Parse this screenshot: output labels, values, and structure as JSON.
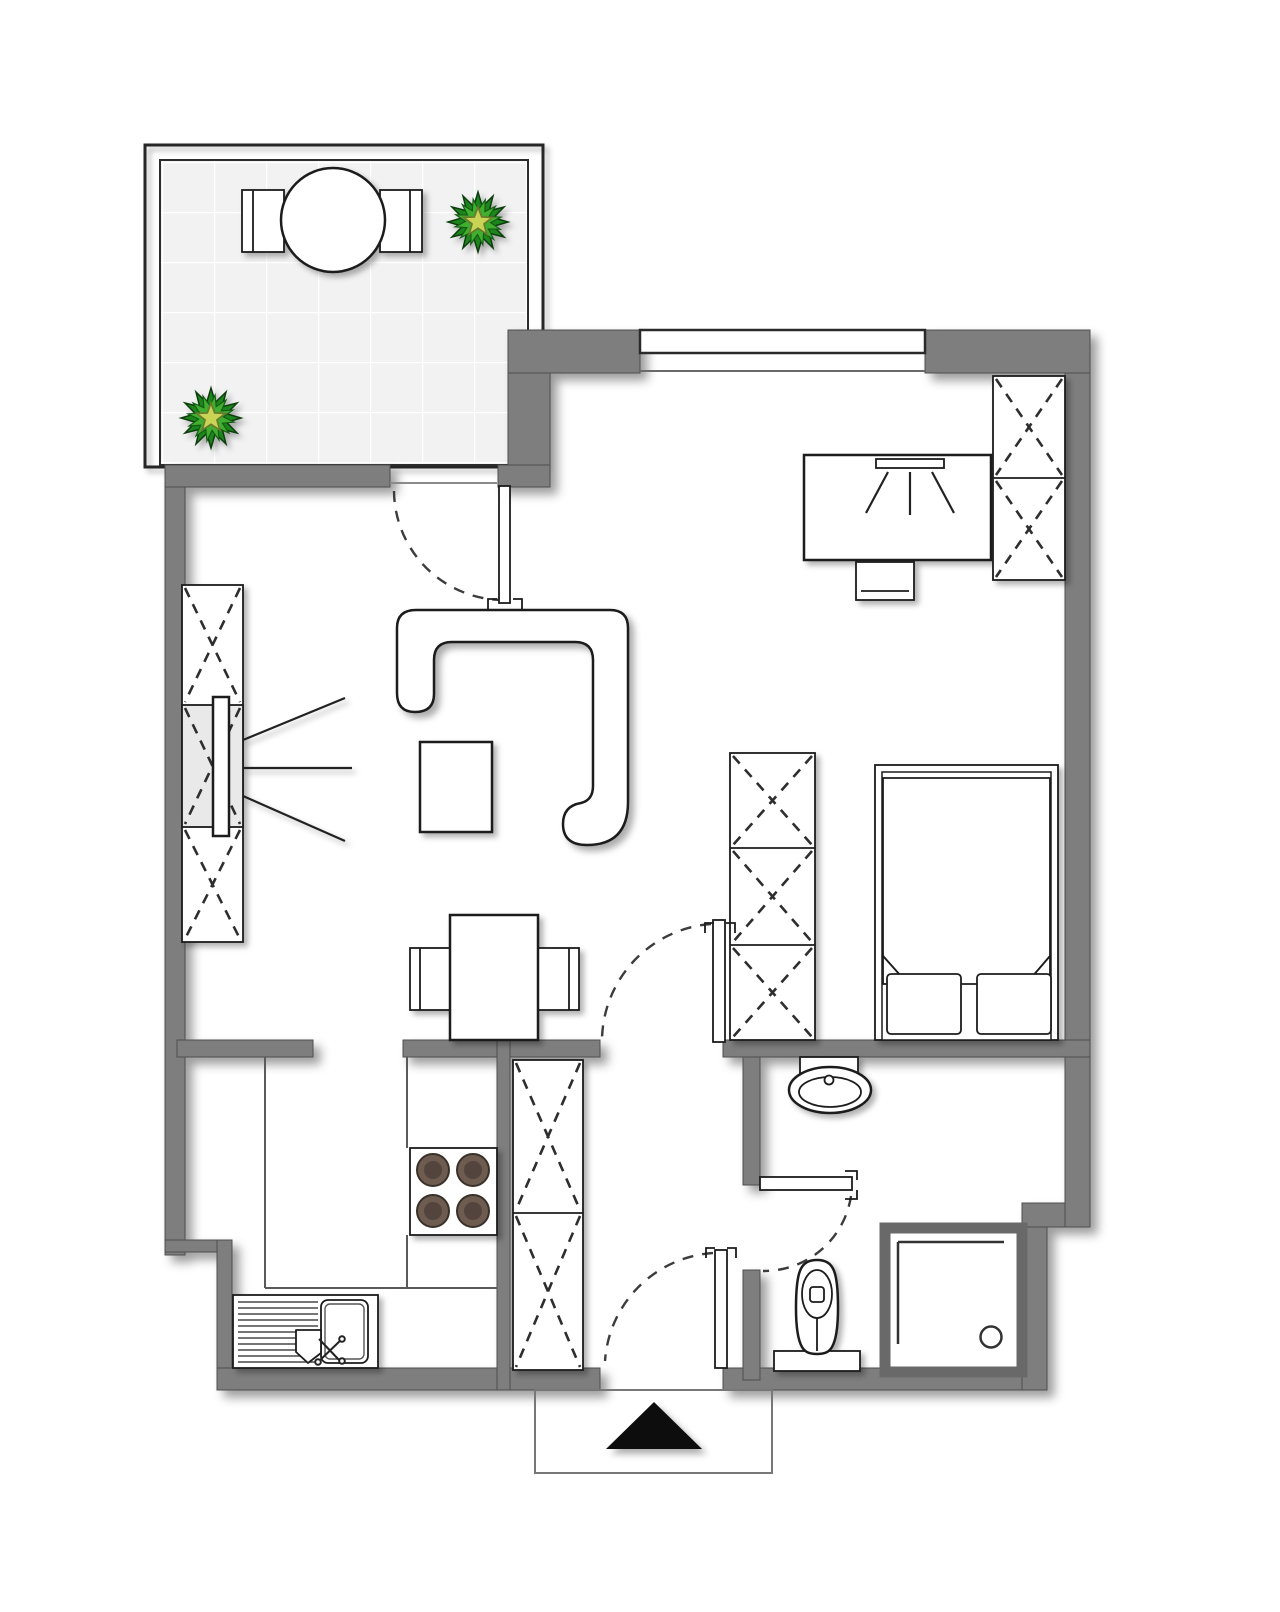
{
  "plan": {
    "type": "apartment-floor-plan",
    "canvas": {
      "width": 1280,
      "height": 1612
    }
  },
  "colors": {
    "background": "#ffffff",
    "wall": "#7e7e7e",
    "outline": "#1b1b1b",
    "tile": "#f2f2f2",
    "tile_grid": "#ffffff",
    "shaded_shelf": "#e9e9e9",
    "plant_dark": "#1f851d",
    "plant_light": "#3fae2d",
    "plant_star": "#c9d455",
    "burner": "#6d5b4f",
    "burner_inner": "#52443c",
    "entry_arrow": "#0d0d0d",
    "shower_frame": "#696969"
  },
  "rooms": [
    {
      "name": "balcony",
      "furniture": [
        "round-table",
        "chair",
        "chair",
        "plant",
        "plant"
      ],
      "floor": "tiles"
    },
    {
      "name": "living-area",
      "furniture": [
        "corner-sofa",
        "coffee-table",
        "tv",
        "wardrobe-3-sections",
        "dining-table",
        "chair",
        "chair"
      ]
    },
    {
      "name": "sleeping-area",
      "furniture": [
        "double-bed",
        "pillow",
        "pillow",
        "blanket",
        "desk",
        "desk-chair",
        "desk-lamp",
        "wardrobe-2-sections",
        "wardrobe-3-sections"
      ]
    },
    {
      "name": "kitchen",
      "furniture": [
        "sink-unit",
        "stove-4-burners",
        "counter"
      ]
    },
    {
      "name": "hallway",
      "furniture": [
        "cabinet-2-sections"
      ]
    },
    {
      "name": "bathroom",
      "furniture": [
        "washbasin",
        "toilet",
        "shower"
      ]
    }
  ],
  "features": {
    "doors": [
      "balcony-door",
      "living-room-door",
      "bathroom-door",
      "entrance-door"
    ],
    "windows": [
      "bedroom-window"
    ],
    "entry_marker": "black-triangle",
    "wardrobe_symbol": "dashed-x",
    "door_symbol": "leaf-with-dashed-swing-arc"
  }
}
